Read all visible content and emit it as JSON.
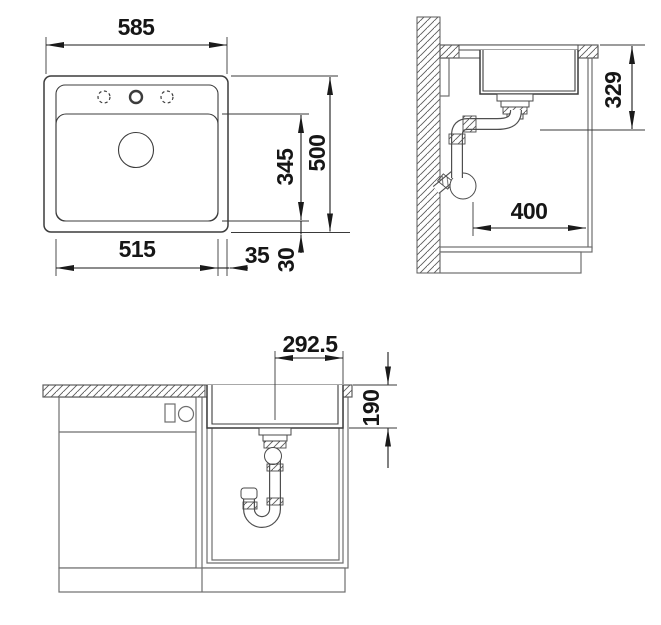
{
  "drawing_type": "sink-installation-technical-drawing",
  "views": {
    "top": {
      "name": "top view",
      "dim_overall_width": "585",
      "dim_overall_depth": "500",
      "dim_basin_width": "515",
      "dim_basin_depth": "345",
      "dim_side_ledge": "35",
      "dim_front_ledge": "30"
    },
    "side": {
      "name": "side section view",
      "dim_drain_height": "329",
      "dim_clearance": "400"
    },
    "front": {
      "name": "front section view",
      "dim_center_offset": "292.5",
      "dim_bowl_depth": "190"
    }
  },
  "colors": {
    "background": "#ffffff",
    "sink_outline": "#3c3c3c",
    "furniture_line": "#6e6e6e",
    "dimension_line": "#1a1a1a",
    "text": "#161616"
  }
}
